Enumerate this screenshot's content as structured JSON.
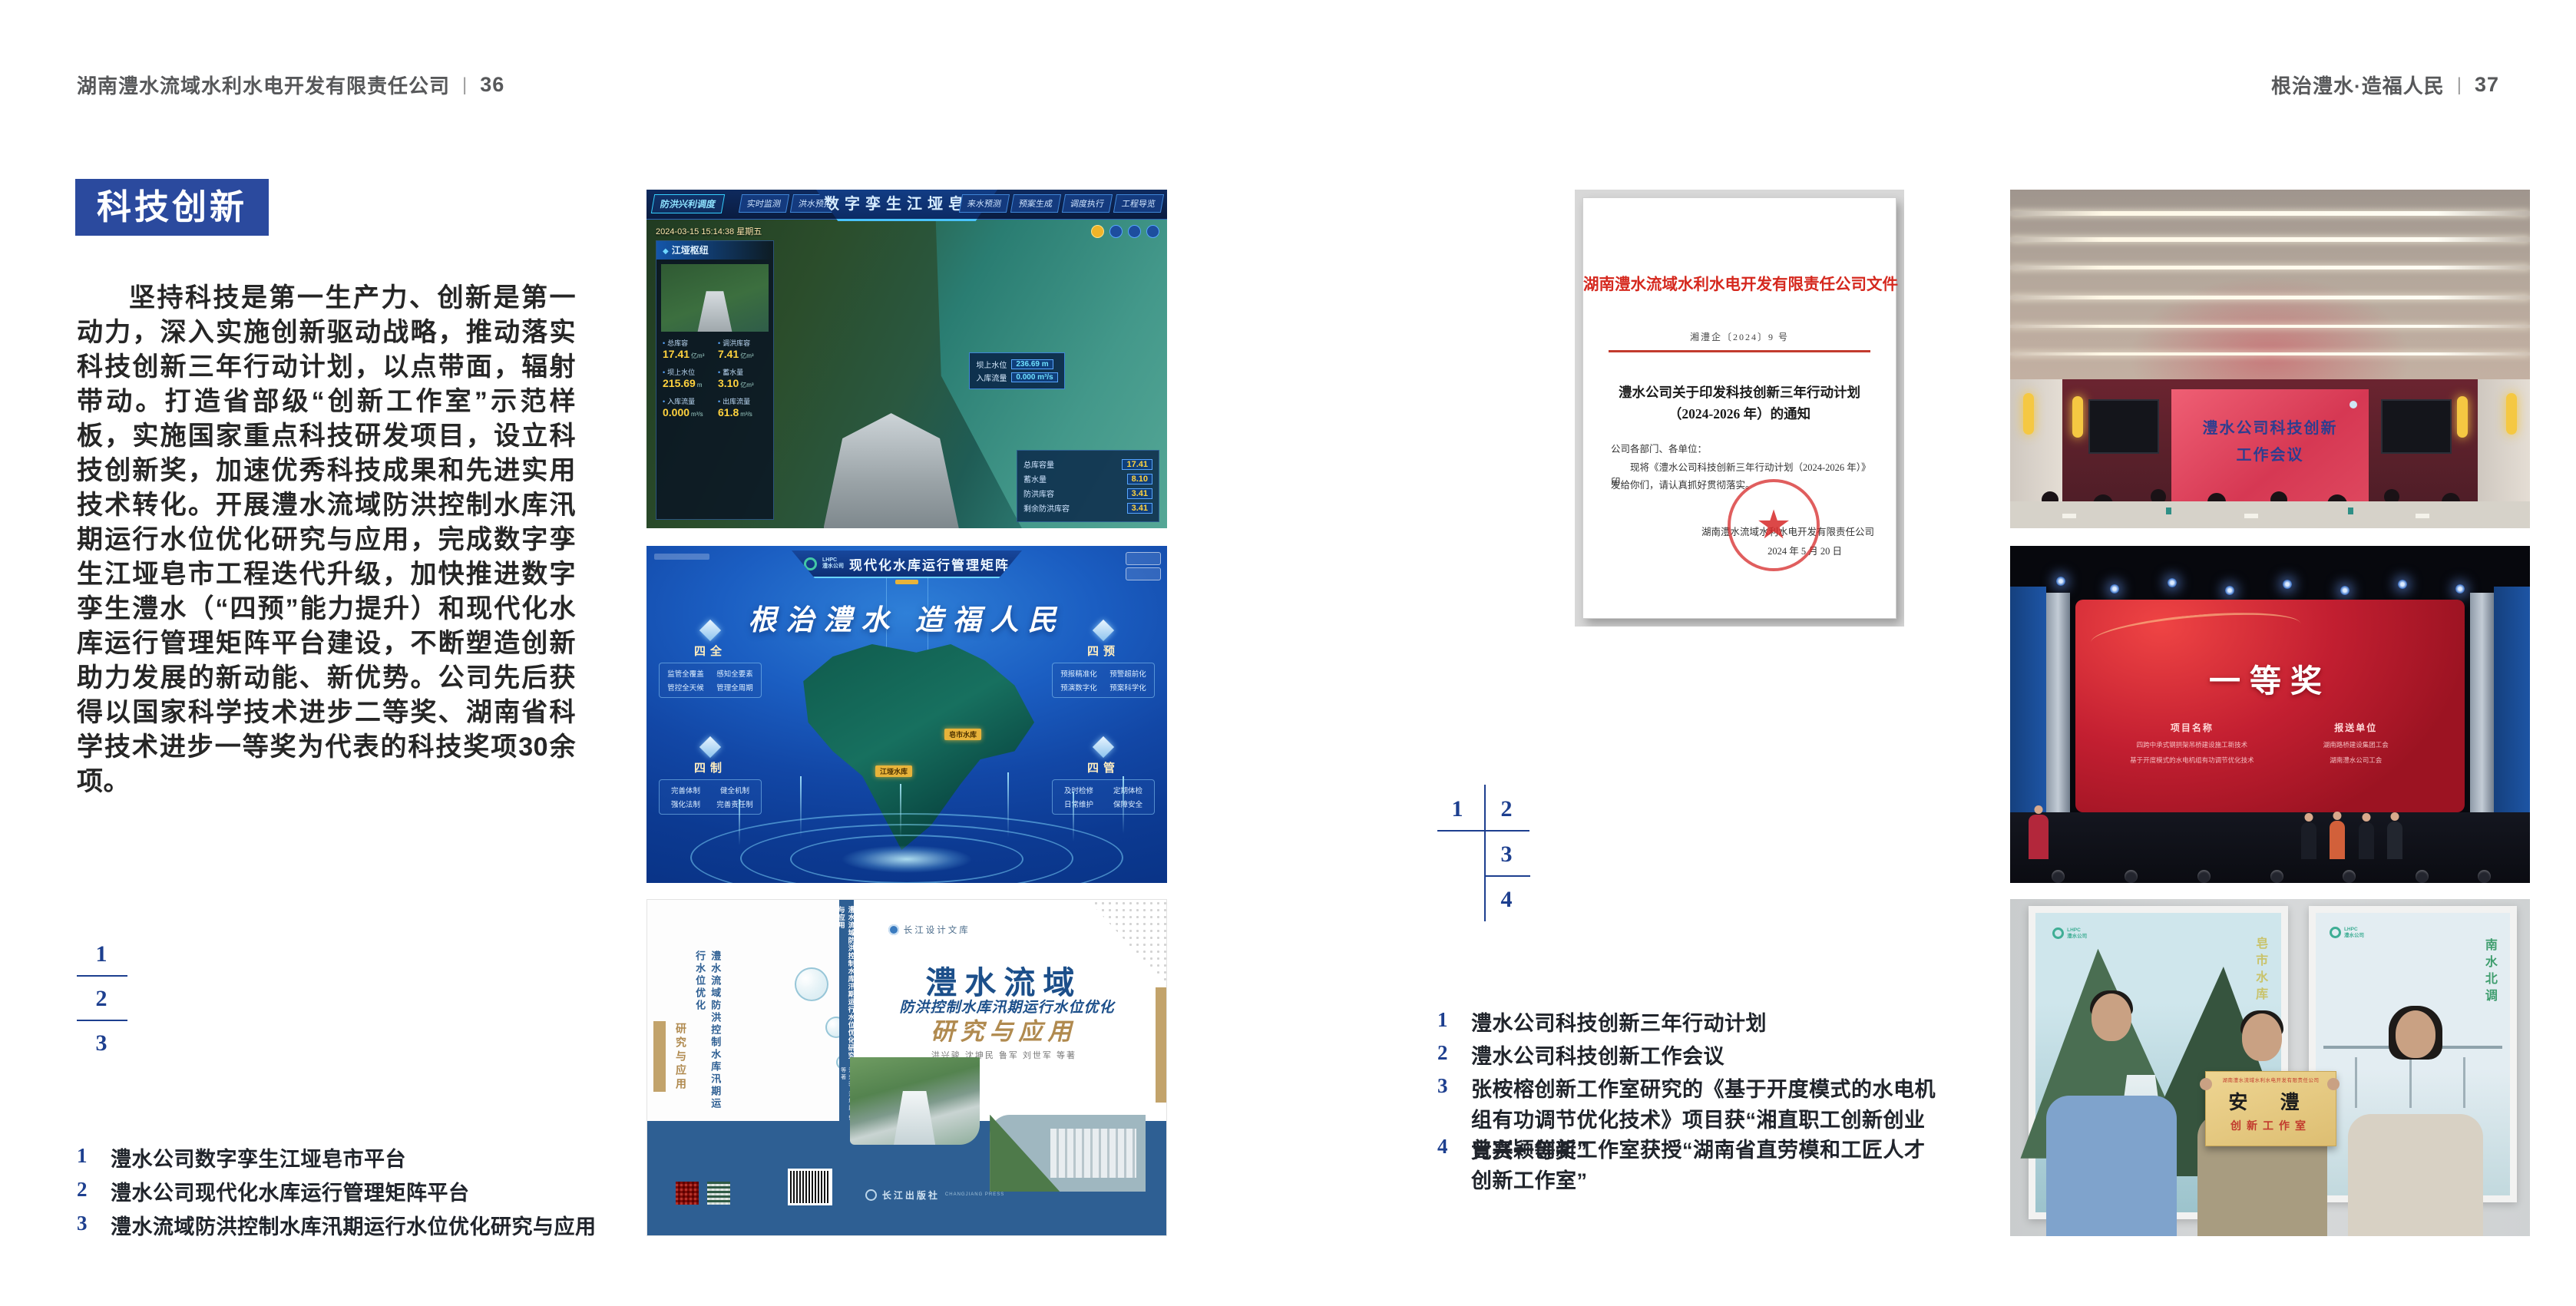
{
  "header": {
    "left": {
      "title": "湖南澧水流域水利水电开发有限责任公司",
      "divider": "|",
      "page_num": "36"
    },
    "right": {
      "title": "根治澧水·造福人民",
      "divider": "|",
      "page_num": "37"
    }
  },
  "left_page": {
    "badge": "科技创新",
    "body": "坚持科技是第一生产力、创新是第一动力，深入实施创新驱动战略，推动落实科技创新三年行动计划，以点带面，辐射带动。打造省部级“创新工作室”示范样板，实施国家重点科技研发项目，设立科技创新奖，加速优秀科技成果和先进实用技术转化。开展澧水流域防洪控制水库汛期运行水位优化研究与应用，完成数字孪生江垭皂市工程迭代升级，加快推进数字孪生澧水（“四预”能力提升）和现代化水库运行管理矩阵平台建设，不断塑造创新助力发展的新动能、新优势。公司先后获得以国家科学技术进步二等奖、湖南省科学技术进步一等奖为代表的科技奖项30余项。",
    "index_numbers": [
      "1",
      "2",
      "3"
    ],
    "captions": [
      {
        "num": "1",
        "text": "澧水公司数字孪生江垭皂市平台"
      },
      {
        "num": "2",
        "text": "澧水公司现代化水库运行管理矩阵平台"
      },
      {
        "num": "3",
        "text": "澧水流域防洪控制水库汛期运行水位优化研究与应用"
      }
    ]
  },
  "right_page": {
    "index_numbers": [
      "1",
      "2",
      "3",
      "4"
    ],
    "captions": [
      {
        "num": "1",
        "text": "澧水公司科技创新三年行动计划"
      },
      {
        "num": "2",
        "text": "澧水公司科技创新工作会议"
      },
      {
        "num": "3",
        "text": "张桉榕创新工作室研究的《基于开度模式的水电机组有功调节优化技术》项目获“湘直职工创新创业竞赛一等奖”"
      },
      {
        "num": "4",
        "text": "曾兴颖创新工作室获授“湖南省直劳模和工匠人才创新工作室”"
      }
    ]
  },
  "fig_dashboard": {
    "title": "数字孪生江垭皂市",
    "menu_label": "防洪兴利调度",
    "tabs_left": [
      "实时监测",
      "洪水预报",
      "防汛预警"
    ],
    "tabs_right": [
      "来水预测",
      "预案生成",
      "调度执行",
      "工程导览"
    ],
    "timestamp": "2024-03-15 15:14:38 星期五",
    "panel_title": "江垭枢纽",
    "stats": [
      {
        "label": "总库容",
        "value": "17.41",
        "unit": "亿m³"
      },
      {
        "label": "调洪库容",
        "value": "7.41",
        "unit": "亿m³"
      },
      {
        "label": "坝上水位",
        "value": "215.69",
        "unit": "m"
      },
      {
        "label": "蓄水量",
        "value": "3.10",
        "unit": "亿m³"
      },
      {
        "label": "入库流量",
        "value": "0.000",
        "unit": "m³/s"
      },
      {
        "label": "出库流量",
        "value": "61.8",
        "unit": "m³/s"
      }
    ],
    "tag1_label": "坝上水位",
    "tag1_value": "236.69 m",
    "tag2_label": "入库流量",
    "tag2_value": "0.000 m³/s",
    "info_rows": [
      {
        "label": "总库容量",
        "value": "17.41"
      },
      {
        "label": "蓄水量",
        "value": "8.10"
      },
      {
        "label": "防洪库容",
        "value": "3.41"
      },
      {
        "label": "剩余防洪库容",
        "value": "3.41"
      }
    ]
  },
  "fig_matrix": {
    "logo_abbr": "LHPC",
    "logo_name": "澧水公司",
    "title": "现代化水库运行管理矩阵",
    "slogan": "根治澧水 造福人民",
    "quadrants": [
      {
        "name": "四全",
        "items": [
          "监管全覆盖",
          "感知全要素",
          "管控全天候",
          "管理全周期"
        ]
      },
      {
        "name": "四预",
        "items": [
          "预报精准化",
          "预警超前化",
          "预演数字化",
          "预案科学化"
        ]
      },
      {
        "name": "四制",
        "items": [
          "完善体制",
          "健全机制",
          "强化法制",
          "完善责任制"
        ]
      },
      {
        "name": "四管",
        "items": [
          "及时检修",
          "定期体检",
          "日常维护",
          "保障安全"
        ]
      }
    ],
    "markers": [
      "皂市水库",
      "江垭水库"
    ]
  },
  "fig_book": {
    "series": "长江设计文库",
    "title1": "澧水流域",
    "title2": "防洪控制水库汛期运行水位优化",
    "title3": "研究与应用",
    "authors": "洪兴骏  沈坤民  鲁军  刘世军  等著",
    "spine": "澧水流域防洪控制水库汛期运行水位优化研究与应用",
    "back_title": "澧水流域防洪控制水库汛期运行水位优化",
    "back_subtitle": "研究与应用",
    "publisher": "长江出版社",
    "publisher_en": "CHANGJIANG PRESS"
  },
  "fig_document": {
    "header": "湖南澧水流域水利水电开发有限责任公司文件",
    "doc_no": "湘澧企〔2024〕9 号",
    "title1": "澧水公司关于印发科技创新三年行动计划",
    "title2": "（2024-2026 年）的通知",
    "salutation": "公司各部门、各单位：",
    "body1": "现将《澧水公司科技创新三年行动计划（2024-2026 年）》印",
    "body2": "发给你们，请认真抓好贯彻落实。",
    "signer": "湖南澧水流域水利水电开发有限责任公司",
    "date": "2024 年 5 月 20 日"
  },
  "fig_meeting": {
    "screen1": "澧水公司科技创新",
    "screen2": "工作会议"
  },
  "fig_award": {
    "title": "一等奖",
    "col1": "项目名称",
    "col2": "报送单位",
    "rows": [
      {
        "project": "四跨中承式钢拱架吊桥建设施工新技术",
        "org": "湖南路桥建设集团工会"
      },
      {
        "project": "基于开度模式的水电机组有功调节优化技术",
        "org": "湖南澧水公司工会"
      }
    ]
  },
  "fig_group": {
    "plaque_org": "湖南澧水流域水利水电开发有限责任公司",
    "plaque_name": "安  澧",
    "plaque_sub": "创新工作室",
    "poster_left_text": "皂市水库",
    "poster_right_text": "南水北调"
  }
}
